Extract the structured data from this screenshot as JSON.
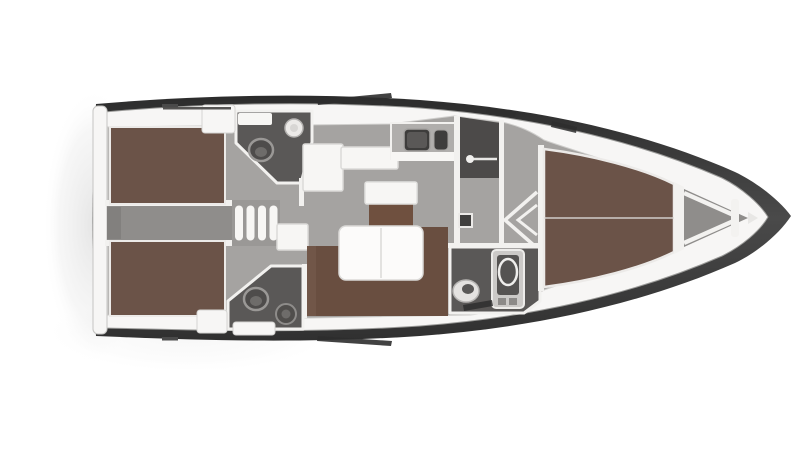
{
  "image": {
    "kind": "sailing-yacht-interior-floor-plan",
    "view": "top-down 3D render, bow pointing right, stern at left, white background"
  },
  "colors": {
    "background": "#ffffff",
    "hull_outline": "#3a3a3a",
    "deck": "#f7f6f5",
    "floor": "#a5a3a1",
    "corridor_floor": "#8f8d8b",
    "head_floor": "#5a5857",
    "shower_floor": "#4c4a49",
    "berth": "#6b5348",
    "settee": "#694e40",
    "table_wood": "#6f503f",
    "furniture_white": "#f7f6f4",
    "wall": "#f2f1ef",
    "hatch": "#2e2e2e",
    "shadow": "#cfcfcf"
  },
  "vessel": {
    "regions": [
      {
        "id": "aft-cabin-port",
        "contents": [
          "double-berth"
        ]
      },
      {
        "id": "aft-cabin-starboard",
        "contents": [
          "double-berth"
        ]
      },
      {
        "id": "aft-head-port",
        "contents": [
          "toilet",
          "sink"
        ]
      },
      {
        "id": "aft-head-starboard",
        "contents": [
          "toilet",
          "shower-drain"
        ]
      },
      {
        "id": "engine-corridor",
        "contents": [
          "companionway-stairs",
          "engine-hatch"
        ]
      },
      {
        "id": "salon",
        "contents": [
          "l-shaped-seat",
          "coffee-table",
          "dining-table",
          "settee",
          "side-cabinet"
        ]
      },
      {
        "id": "galley",
        "contents": [
          "counter",
          "double-sink"
        ]
      },
      {
        "id": "shower-room",
        "contents": [
          "shower-rail"
        ]
      },
      {
        "id": "passage",
        "contents": [
          "door-chevrons",
          "door-handle"
        ]
      },
      {
        "id": "forward-head",
        "contents": [
          "toilet",
          "shower-column"
        ]
      },
      {
        "id": "forward-cabin",
        "contents": [
          "v-berth",
          "centerline"
        ]
      },
      {
        "id": "anchor-locker",
        "contents": [
          "v-struts"
        ]
      },
      {
        "id": "deck",
        "contents": [
          "hatches",
          "windows",
          "handrail",
          "transom-platform",
          "deck-boxes"
        ]
      }
    ]
  }
}
